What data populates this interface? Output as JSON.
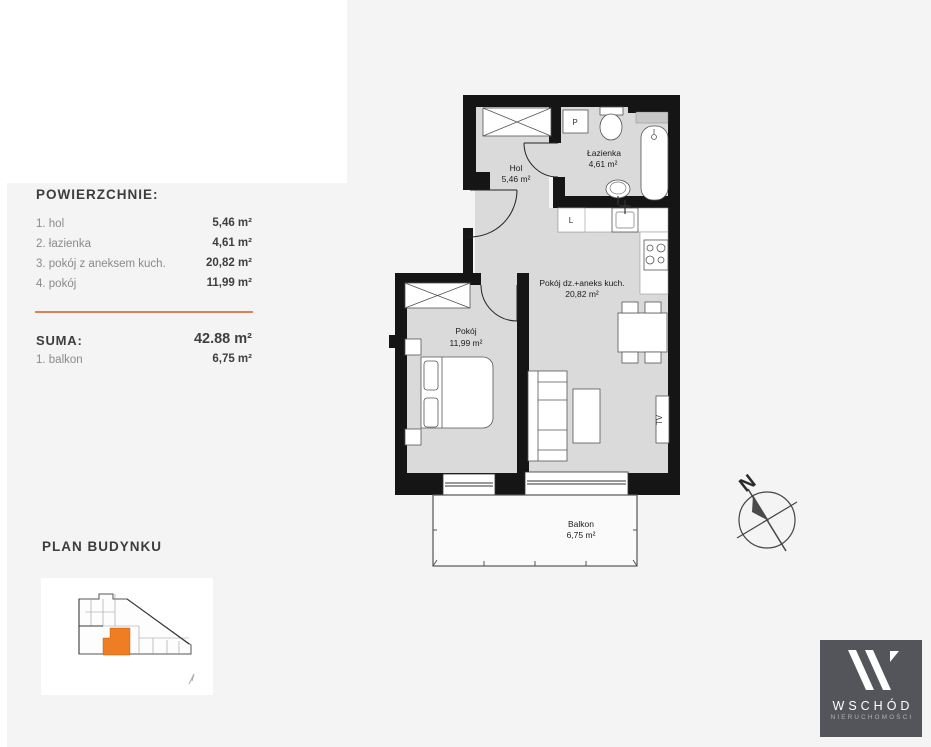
{
  "panel": {
    "title": "POWIERZCHNIE:",
    "rows": [
      {
        "label": "1. hol",
        "value": "5,46 m²"
      },
      {
        "label": "2. łazienka",
        "value": "4,61 m²"
      },
      {
        "label": "3. pokój z aneksem kuch.",
        "value": "20,82 m²"
      },
      {
        "label": "4. pokój",
        "value": "11,99 m²"
      }
    ],
    "suma_label": "SUMA:",
    "suma_value": "42.88 m²",
    "balkon_label": "1. balkon",
    "balkon_value": "6,75 m²"
  },
  "building": {
    "title": "PLAN BUDYNKU"
  },
  "plan": {
    "rooms": [
      {
        "name": "hol",
        "label": "Hol",
        "area": "5,46 m²"
      },
      {
        "name": "lazienka",
        "label": "Łazienka",
        "area": "4,61 m²"
      },
      {
        "name": "pokoj-dzienny",
        "label": "Pokój dz.+aneks kuch.",
        "area": "20,82 m²"
      },
      {
        "name": "pokoj",
        "label": "Pokój",
        "area": "11,99 m²"
      },
      {
        "name": "balkon",
        "label": "Balkon",
        "area": "6,75 m²"
      }
    ],
    "fixtures": {
      "washer": "P",
      "fridge": "L",
      "tv": "TV"
    },
    "compass_n": "N"
  },
  "logo": {
    "name": "WSCHÓD",
    "subtitle": "NIERUCHOMOŚCI"
  },
  "colors": {
    "page_bg": "#f4f4f4",
    "divider_accent": "#dd8157",
    "highlight_unit": "#ee7d23",
    "wall": "#151515",
    "room_floor": "#dadada",
    "logo_bg": "#54555a"
  }
}
